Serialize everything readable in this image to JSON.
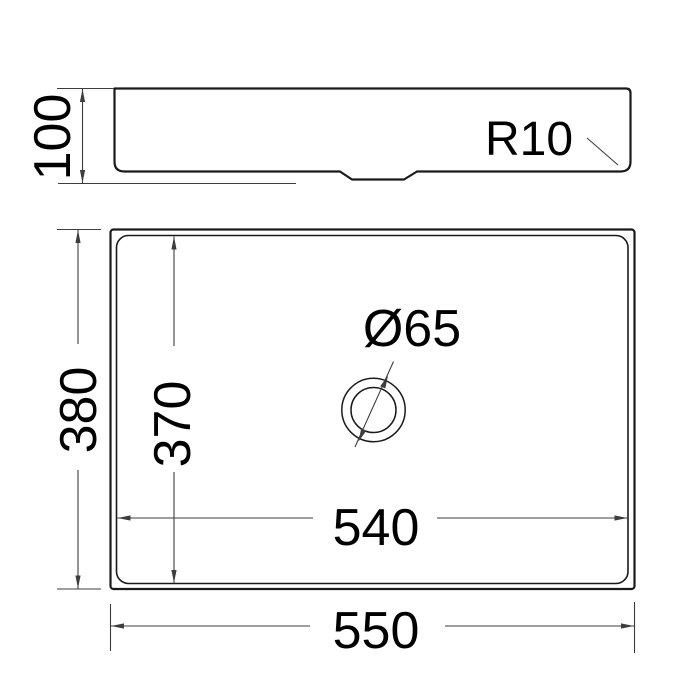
{
  "drawing": {
    "description": "Technical dimension drawing of a rectangular vessel sink, side profile view above and top plan view below",
    "side_view": {
      "height": "100",
      "corner_radius": "R10"
    },
    "top_view": {
      "outer_height": "380",
      "inner_height": "370",
      "inner_width": "540",
      "outer_width": "550",
      "drain_diameter": "Ø65"
    },
    "colors": {
      "outline": "#1a1a1a",
      "dimension_line": "#3d3d3d",
      "text": "#000000",
      "background": "#ffffff"
    }
  }
}
